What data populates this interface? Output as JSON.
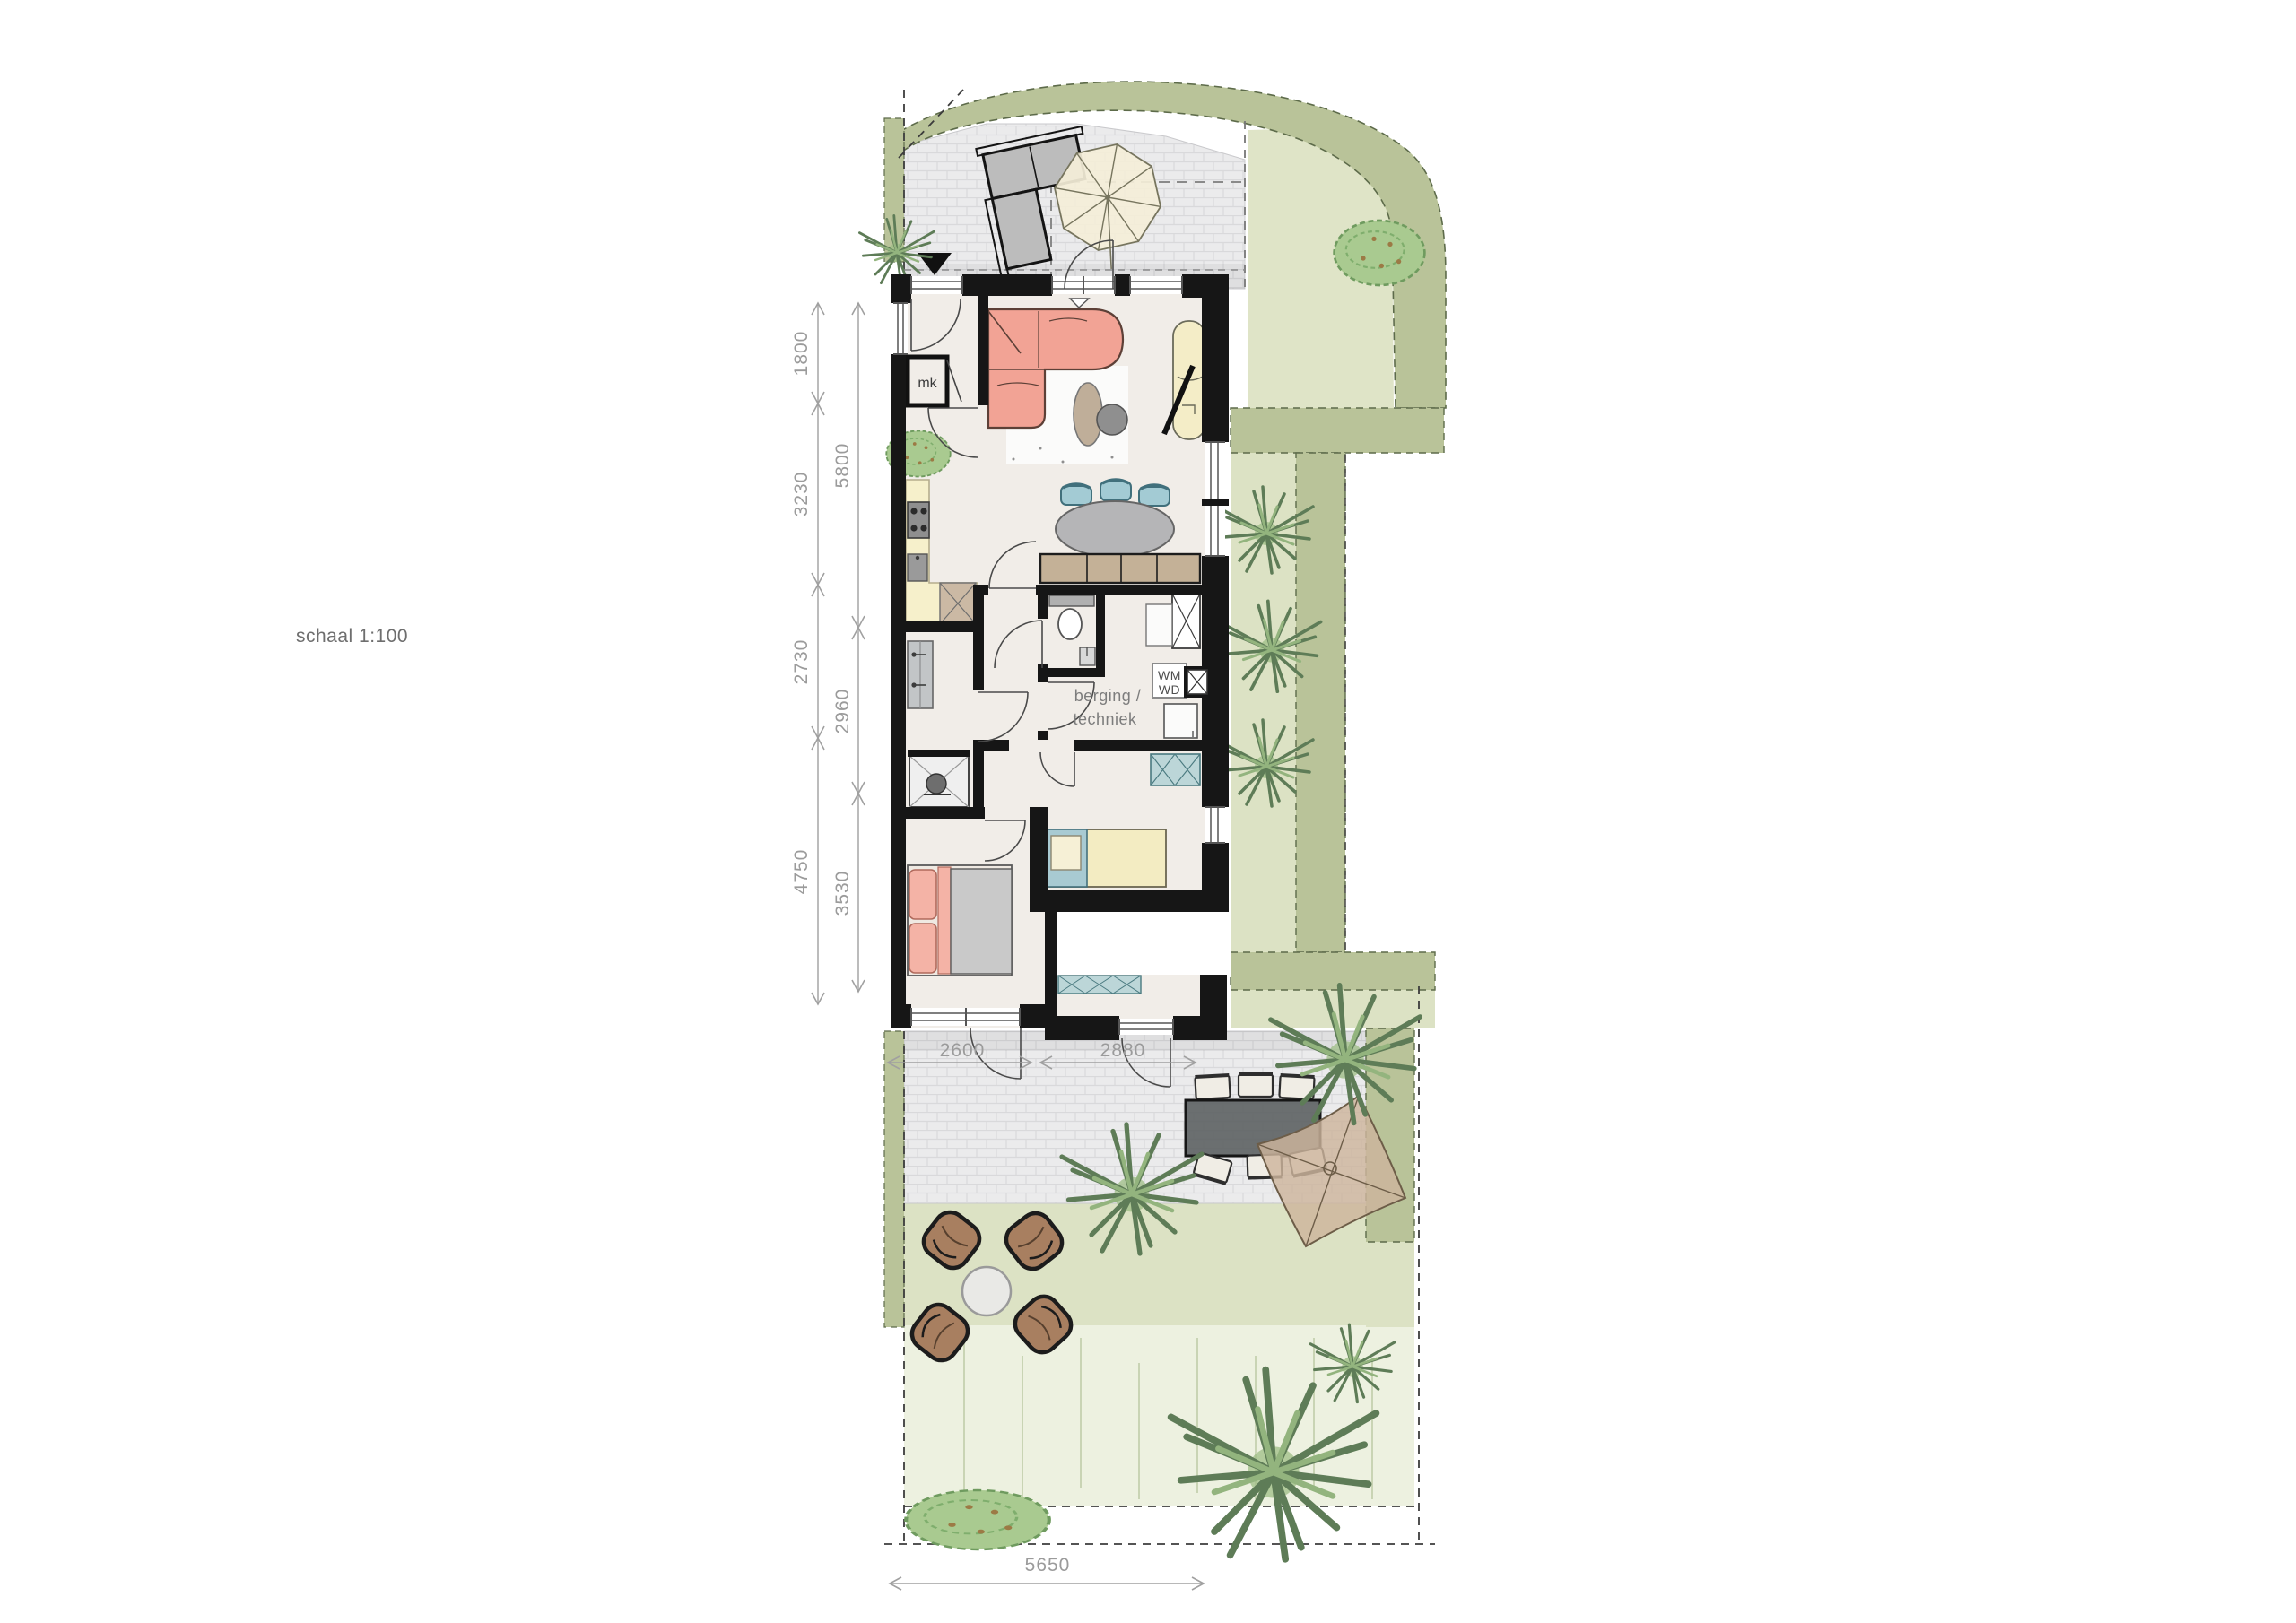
{
  "meta": {
    "scale_label": "schaal 1:100",
    "drawing_type": "floor-plan-with-garden"
  },
  "labels": {
    "meter_cupboard": "mk",
    "storage_room_line1": "berging /",
    "storage_room_line2": "techniek",
    "washing_machine": "WM",
    "dryer": "WD"
  },
  "dimensions": {
    "left_outer": [
      "1800",
      "3230",
      "2730",
      "4750"
    ],
    "left_inner": [
      "5800",
      "2960",
      "3530"
    ],
    "bottom_house": [
      "2600",
      "2880"
    ],
    "garden_width": "5650"
  },
  "colors": {
    "wall": "#161616",
    "floor": "#f1ede8",
    "paving": "#ebebec",
    "hedge": "#b9c399",
    "lawn_sage": "#dce2c4",
    "lawn_light": "#edf1e0",
    "sofa_pink": "#f2a395",
    "bed_gray": "#c9c9c9",
    "kitchen_counter": "#f6f0cb",
    "chair_blue": "#a3cbd4",
    "cabinet_teal": "#bcd6d8",
    "outdoor_chair_brown": "#a87f60",
    "sail_tan": "#cdb59c",
    "dim_gray": "#9b9b9b"
  }
}
